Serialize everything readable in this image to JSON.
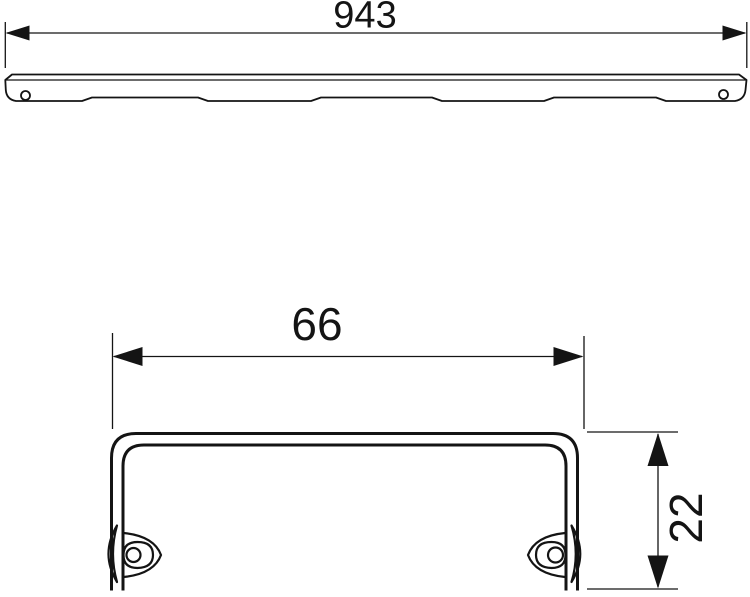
{
  "drawing": {
    "background_color": "#ffffff",
    "line_color": "#141414",
    "dimensions": {
      "overall_length": "943",
      "profile_width": "66",
      "profile_height": "22"
    }
  }
}
